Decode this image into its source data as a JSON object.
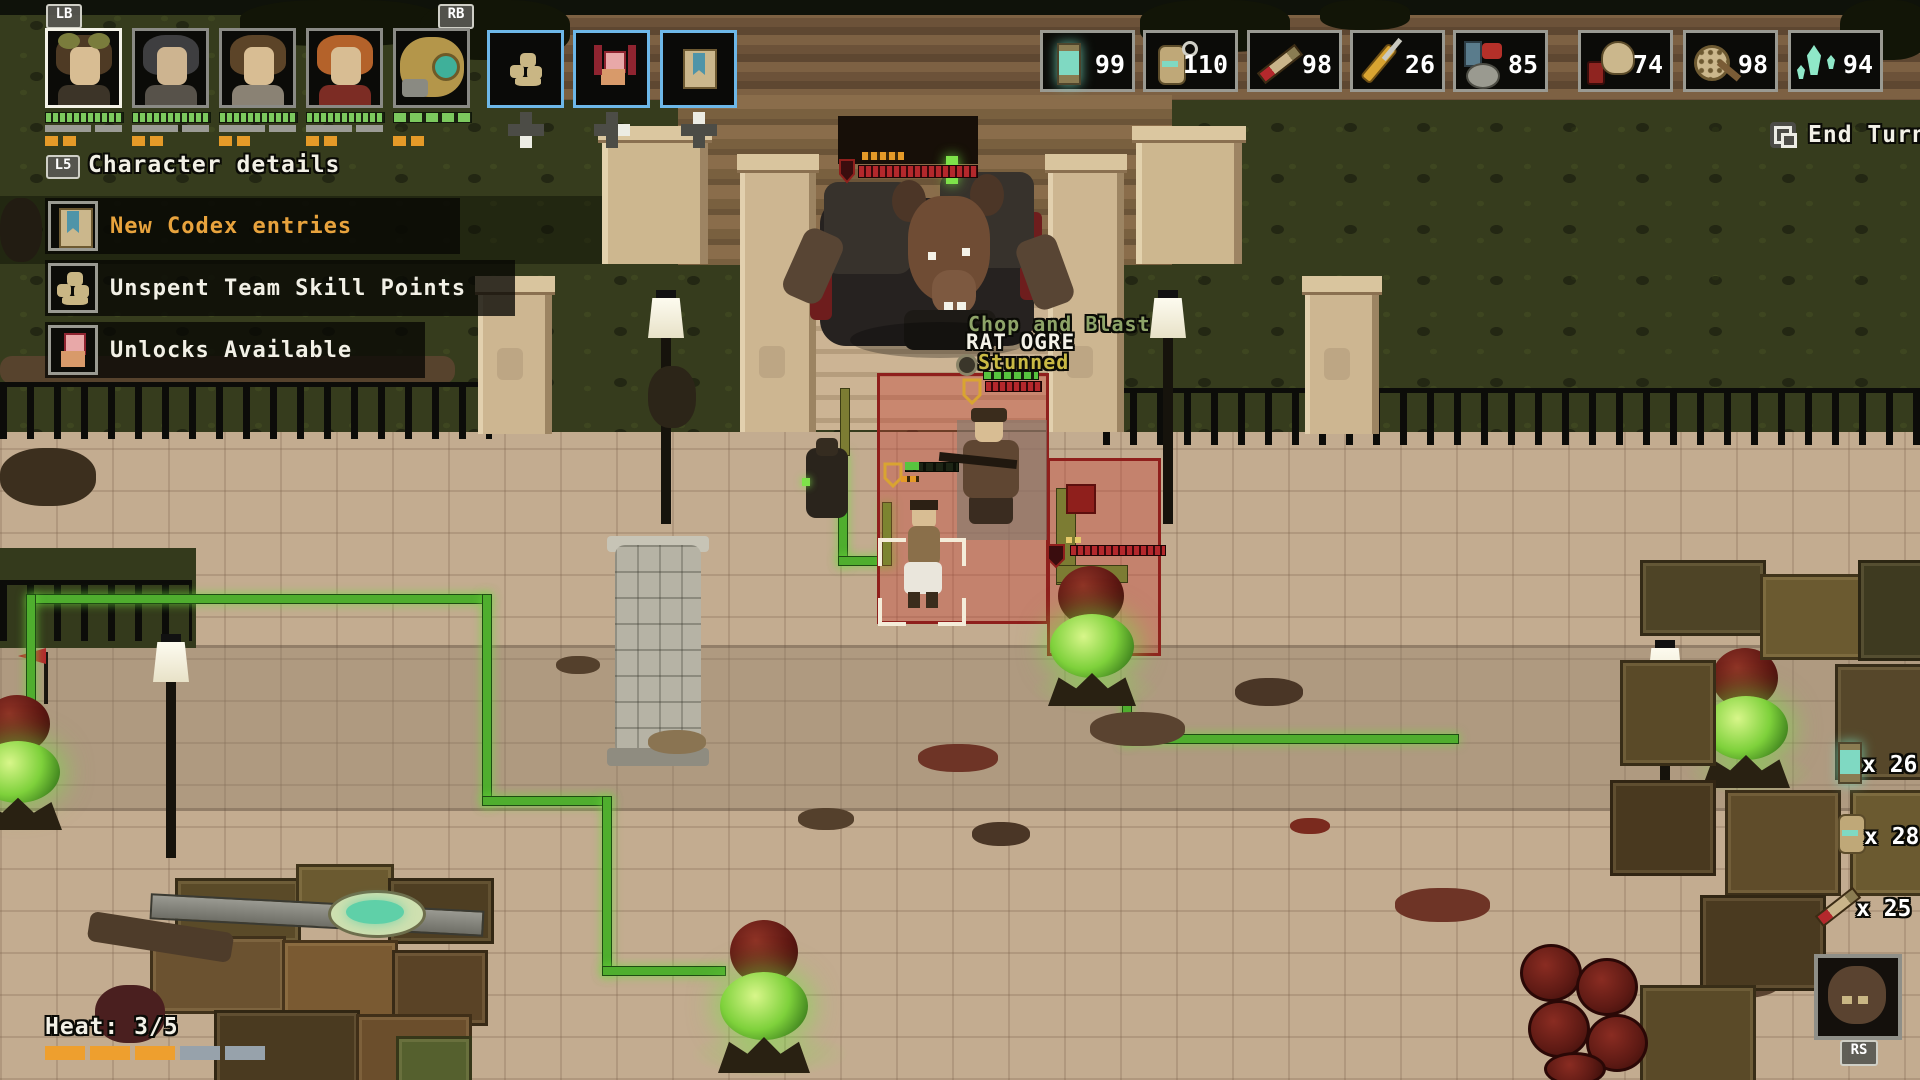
{
  "hud": {
    "buttons": {
      "lb": "LB",
      "rb": "RB",
      "l5": "L5",
      "rs": "RS"
    },
    "header_label": "Character details",
    "end_turn_label": "End Turn",
    "notifications": [
      {
        "icon": "codex-book",
        "label": "New Codex entries"
      },
      {
        "icon": "team-skill",
        "label": "Unspent Team Skill Points"
      },
      {
        "icon": "unlocks",
        "label": "Unlocks Available"
      }
    ],
    "items": [
      {
        "icon": "lantern",
        "count": "99"
      },
      {
        "icon": "grenade",
        "count": "110"
      },
      {
        "icon": "syringe",
        "count": "98"
      },
      {
        "icon": "tools",
        "count": "26"
      },
      {
        "icon": "medkit",
        "count": "85"
      },
      {
        "icon": "gas-mask",
        "count": "74"
      },
      {
        "icon": "round-shield",
        "count": "98"
      },
      {
        "icon": "crystals",
        "count": "94"
      }
    ],
    "heat": {
      "label": "Heat: 3/5",
      "filled": 3,
      "total": 5
    },
    "loot_pickups": [
      {
        "icon": "lantern",
        "label": "x 26"
      },
      {
        "icon": "grenade",
        "label": "x 28"
      },
      {
        "icon": "syringe",
        "label": "x 25"
      }
    ]
  },
  "battle": {
    "floating_text": "Chop and Blast",
    "enemy_name": "RAT OGRE",
    "enemy_status": "Stunned"
  },
  "colors": {
    "accent_orange": "#e8a33d",
    "hud_blue": "#6db7e8",
    "path_green": "#4fae2e",
    "zone_red": "#8f1f1c"
  }
}
